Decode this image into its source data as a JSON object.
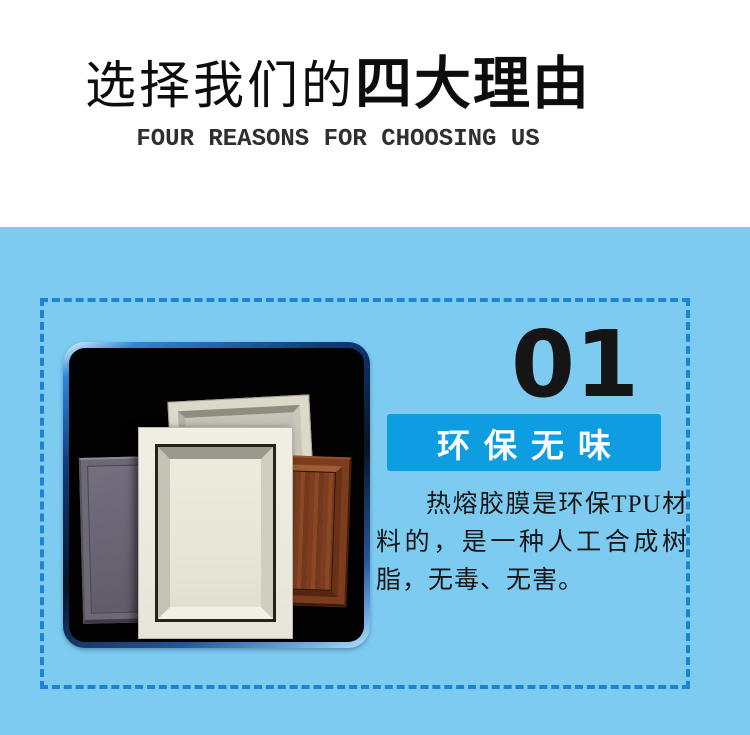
{
  "header": {
    "title_regular": "选择我们的",
    "title_bold": "四大理由",
    "subtitle": "FOUR REASONS FOR CHOOSING US"
  },
  "feature": {
    "number": "01",
    "badge_label": "环保无味",
    "description": "热熔胶膜是环保TPU材料的，是一种人工合成树脂，无毒、无害。",
    "product_image_alt": "四款橱柜门板样品（灰色、米白、白色雕花、红木色）"
  },
  "colors": {
    "section_background": "#7dcbf0",
    "dashed_border": "#1a85d7",
    "badge_background": "#0f9de2",
    "badge_text": "#ffffff",
    "number_text": "#151515",
    "title_text": "#0d0d0d",
    "photo_bezel_blue": "#2e86d8",
    "photo_background": "#020202"
  }
}
